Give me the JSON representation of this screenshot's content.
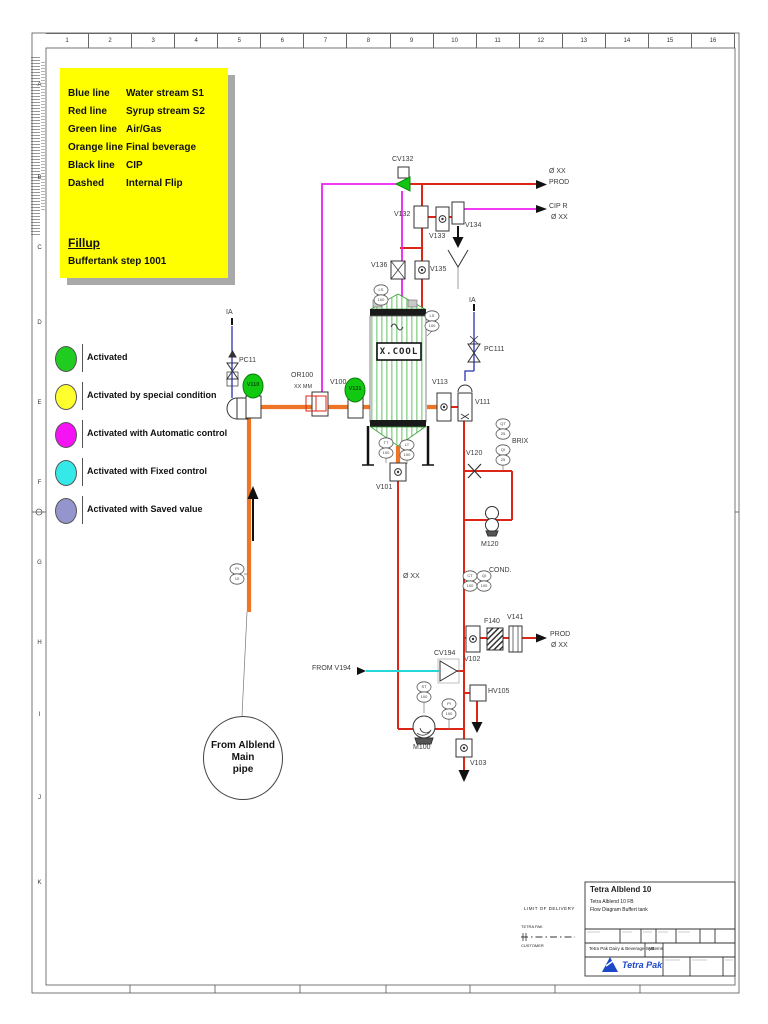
{
  "sheet": {
    "ruler_numbers": [
      "1",
      "2",
      "3",
      "4",
      "5",
      "6",
      "7",
      "8",
      "9",
      "10",
      "11",
      "12",
      "13",
      "14",
      "15",
      "16"
    ],
    "row_letters": [
      "A",
      "B",
      "C",
      "D",
      "E",
      "F",
      "G",
      "H",
      "I",
      "J",
      "K"
    ]
  },
  "legend_box": {
    "rows": [
      {
        "line": "Blue line",
        "desc": "Water stream S1"
      },
      {
        "line": "Red line",
        "desc": "Syrup stream S2"
      },
      {
        "line": "Green line",
        "desc": "Air/Gas"
      },
      {
        "line": "Orange line",
        "desc": "Final beverage"
      },
      {
        "line": "Black line",
        "desc": "CIP"
      },
      {
        "line": "Dashed",
        "desc": "Internal Flip"
      }
    ],
    "title": "Fillup",
    "subtitle": "Buffertank step 1001"
  },
  "status_legend": {
    "items": [
      {
        "label": "Activated",
        "color": "#1fcc1f"
      },
      {
        "label": "Activated by special condition",
        "color": "#ffff2e"
      },
      {
        "label": "Activated with Automatic control",
        "color": "#f513f5"
      },
      {
        "label": "Activated with Fixed control",
        "color": "#35e9e9"
      },
      {
        "label": "Activated with Saved value",
        "color": "#9595cd"
      }
    ]
  },
  "labels": {
    "cv132": "CV132",
    "v132": "V132",
    "v133": "V133",
    "v134": "V134",
    "v135": "V135",
    "v136": "V136",
    "dia_xx": "Ø XX",
    "prod": "PROD",
    "cip_r": "CIP R",
    "ia": "IA",
    "pc11": "PC11",
    "pc111": "PC111",
    "v110": "V110",
    "v131": "V131",
    "or100": "OR100",
    "or100_size": "XX MM",
    "v100": "V100",
    "tank": "X.COOL",
    "v113": "V113",
    "v111": "V111",
    "v120": "V120",
    "m120": "M120",
    "brix": "BRIX",
    "cond": "COND.",
    "v101": "V101",
    "from_v194": "FROM V194",
    "cv194": "CV194",
    "v102": "V102",
    "f140": "F140",
    "v141": "V141",
    "hv105": "HV105",
    "m100": "M100",
    "v103": "V103",
    "from_main_line1": "From Alblend Main",
    "from_main_line2": "pipe"
  },
  "instruments": {
    "tank_top_left": {
      "tag": "LS",
      "num": "100"
    },
    "tank_top_right": {
      "tag": "LS",
      "num": "100"
    },
    "tank_bottom_left": {
      "tag": "TT",
      "num": "100"
    },
    "tank_bottom_right": {
      "tag": "LT",
      "num": "100"
    },
    "brix_upper": {
      "tag": "QT",
      "num": "25"
    },
    "brix_lower": {
      "tag": "QI",
      "num": "25"
    },
    "cond_left": {
      "tag": "CT",
      "num": "100"
    },
    "cond_right": {
      "tag": "QI",
      "num": "100"
    },
    "speed": {
      "tag": "ST",
      "num": "100"
    },
    "pressure": {
      "tag": "PI",
      "num": "100"
    },
    "feed": {
      "tag": "PI",
      "num": "10"
    }
  },
  "title_block": {
    "product": "Tetra Alblend 10",
    "subtitle": "Tetra Alblend 10  FB",
    "doc": "Flow Diagram Buffert tank",
    "company": "Tetra Pak Dairy & Beverage Systems",
    "company_suffix": "AB",
    "logo_text": "Tetra Pak"
  },
  "delivery": {
    "title": "LIMIT OF DELIVERY",
    "party_top": "TETRA PAK",
    "party_bottom": "CUSTOMER"
  },
  "colors": {
    "water_blue": "#2a31b5",
    "syrup_red": "#dc2617",
    "air_green": "#12c912",
    "beverage_orange": "#ee7428",
    "cip_black": "#111111",
    "auto_magenta": "#ef1fef",
    "fixed_cyan": "#22d8d8",
    "saved_purple": "#9595cd",
    "highlight_yellow": "#ffff00"
  }
}
